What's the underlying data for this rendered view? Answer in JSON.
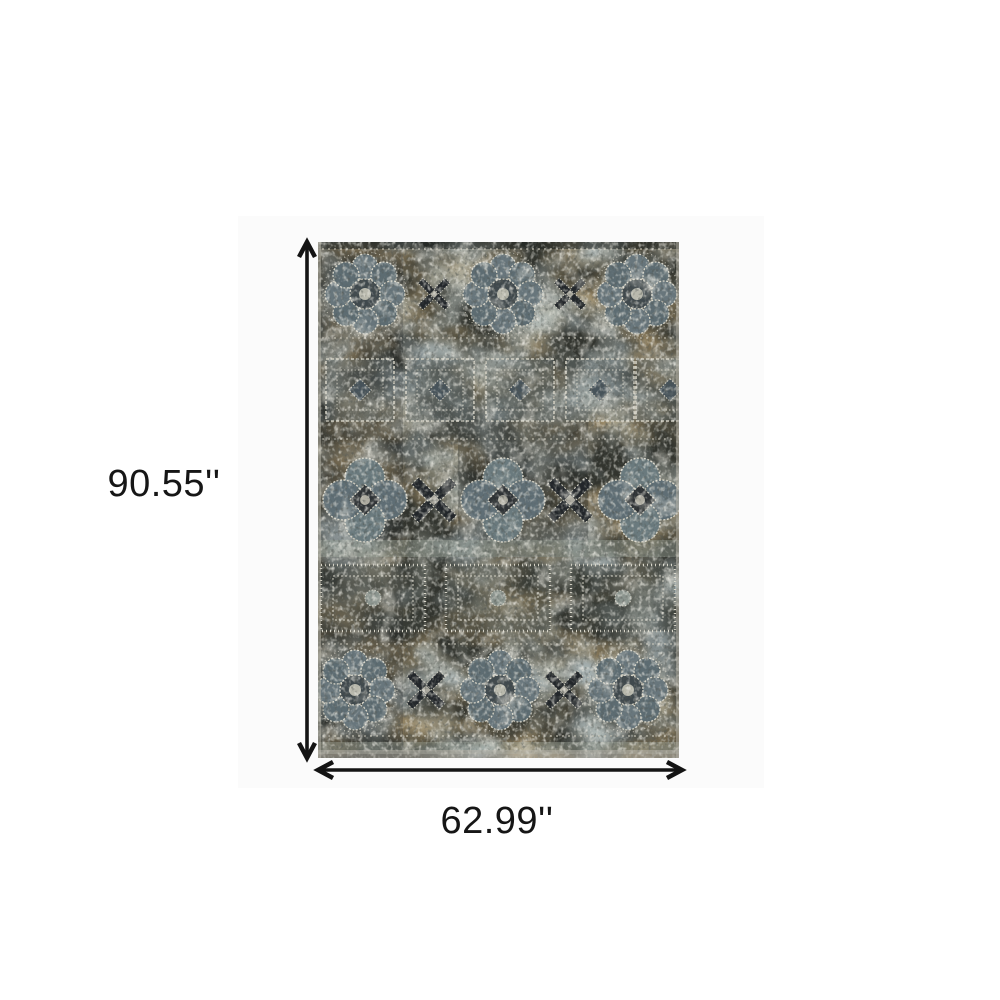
{
  "figure": {
    "type": "rug-dimension-diagram",
    "height_label": "90.55''",
    "width_label": "62.99''"
  },
  "style": {
    "background": "#ffffff",
    "canvas_tint": "#fbfbfb",
    "arrow_color": "#141414",
    "label_color": "#161616"
  },
  "rug": {
    "name": "distressed vintage oriental area rug",
    "palette": {
      "base": "#32342e",
      "charcoal": "#22272a",
      "brown": "#54411f",
      "slate_blue": "#64767d",
      "sage": "#97a095",
      "cream": "#d8d5c8"
    }
  }
}
